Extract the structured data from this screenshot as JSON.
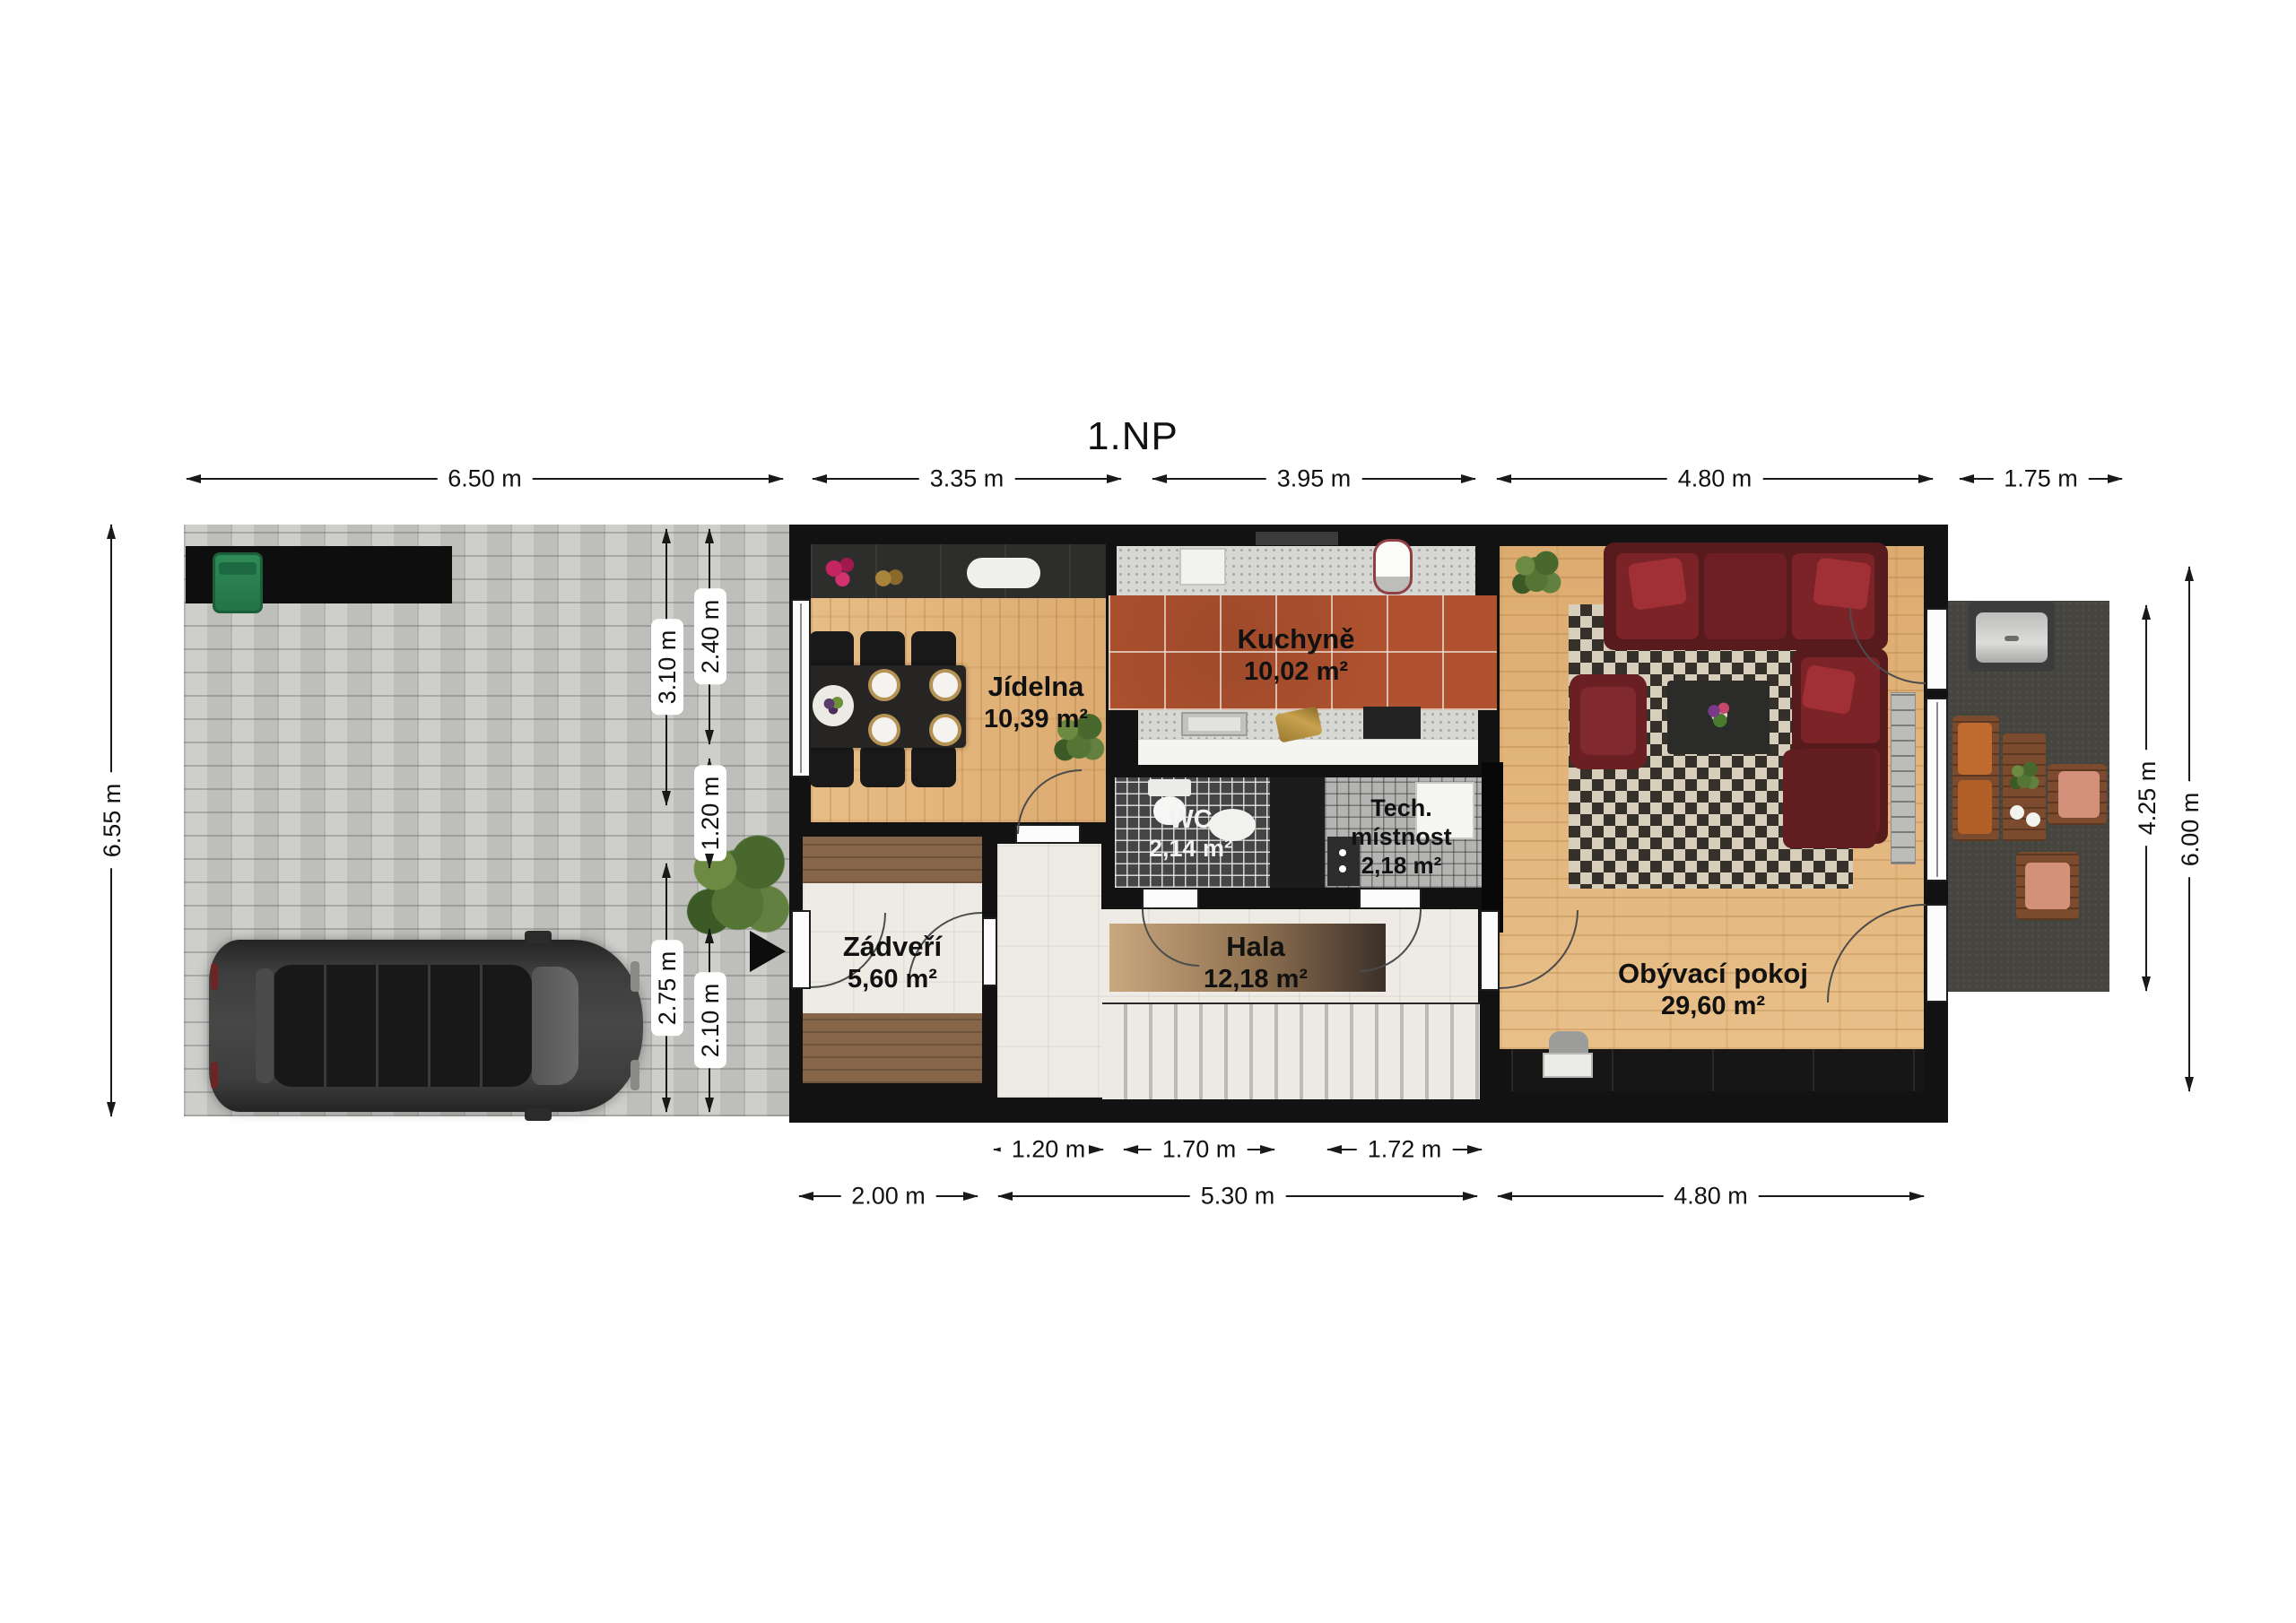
{
  "title": "1.NP",
  "rooms": {
    "jidelna": {
      "name": "Jídelna",
      "area": "10,39 m²"
    },
    "kuchyne": {
      "name": "Kuchyně",
      "area": "10,02 m²"
    },
    "wc": {
      "name": "WC",
      "area": "2,14 m²"
    },
    "tech": {
      "line1": "Tech.",
      "line2": "místnost",
      "area": "2,18 m²"
    },
    "zadveri": {
      "name": "Zádveří",
      "area": "5,60 m²"
    },
    "hala": {
      "name": "Hala",
      "area": "12,18 m²"
    },
    "obyvaci": {
      "name": "Obývací pokoj",
      "area": "29,60 m²"
    }
  },
  "dimensions": {
    "top": [
      "6.50 m",
      "3.35 m",
      "3.95 m",
      "4.80 m",
      "1.75 m"
    ],
    "left": "6.55 m",
    "right": [
      "4.25 m",
      "6.00 m"
    ],
    "inner_left": [
      "3.10 m",
      "2.75 m"
    ],
    "inner_right": [
      "2.40 m",
      "1.20 m",
      "2.10 m"
    ],
    "bottom_upper": [
      "1.20 m",
      "1.70 m",
      "1.72 m"
    ],
    "bottom_lower": [
      "2.00 m",
      "5.30 m",
      "4.80 m"
    ]
  },
  "colors": {
    "wall": "#121212",
    "wood": "#e3b77e",
    "kitchen_tile": "#b0522f",
    "paving": "#c8c8c5",
    "terrace": "#45443f",
    "sofa": "#5d1b1e",
    "bin": "#2f8b57"
  }
}
